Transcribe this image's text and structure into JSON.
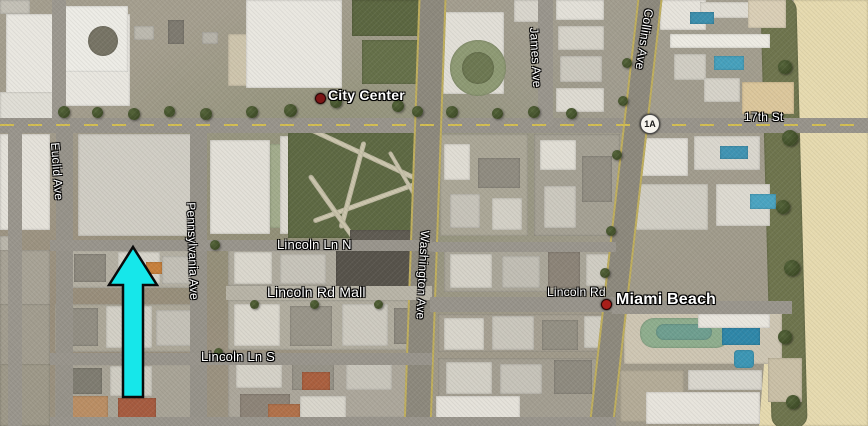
{
  "map": {
    "view": "satellite",
    "place_labels": [
      {
        "text": "City Center",
        "x": 328,
        "y": 87,
        "fs": 14,
        "fw": 600,
        "rot": 0
      },
      {
        "text": "Miami Beach",
        "x": 616,
        "y": 291,
        "fs": 16,
        "fw": 600,
        "rot": 0
      }
    ],
    "street_labels": [
      {
        "text": "17th St",
        "x": 744,
        "y": 110,
        "fs": 12,
        "fw": 400,
        "rot": 0
      },
      {
        "text": "Collins Ave",
        "x": 656,
        "y": 10,
        "fs": 12,
        "fw": 400,
        "rot": 99
      },
      {
        "text": "James Ave",
        "x": 541,
        "y": 27,
        "fs": 12,
        "fw": 400,
        "rot": 87
      },
      {
        "text": "Washington Ave",
        "x": 432,
        "y": 231,
        "fs": 12,
        "fw": 400,
        "rot": 93
      },
      {
        "text": "Pennsylvania Ave",
        "x": 198,
        "y": 202,
        "fs": 12,
        "fw": 400,
        "rot": 88
      },
      {
        "text": "Euclid Ave",
        "x": 62,
        "y": 142,
        "fs": 12,
        "fw": 400,
        "rot": 86
      },
      {
        "text": "Lincoln Ln N",
        "x": 277,
        "y": 237,
        "fs": 13,
        "fw": 400,
        "rot": 0
      },
      {
        "text": "Lincoln Rd Mall",
        "x": 267,
        "y": 284,
        "fs": 14,
        "fw": 400,
        "rot": 0
      },
      {
        "text": "Lincoln Ln S",
        "x": 201,
        "y": 349,
        "fs": 13,
        "fw": 400,
        "rot": 0
      },
      {
        "text": "Lincoln Rd",
        "x": 547,
        "y": 285,
        "fs": 12,
        "fw": 400,
        "rot": 0
      }
    ],
    "markers": [
      {
        "name": "city-center-marker",
        "x": 315,
        "y": 93,
        "d": 9,
        "c": "#7c1616"
      },
      {
        "name": "miami-beach-marker",
        "x": 601,
        "y": 299,
        "d": 9,
        "c": "#a81f1a"
      }
    ],
    "route_shield": {
      "text": "1A",
      "x": 640,
      "y": 114
    },
    "annotation_arrow": {
      "color": "#16e7ea",
      "outline": "#0a0a0a",
      "tip_x": 133,
      "tip_y": 247,
      "head_half": 24,
      "head_base_y": 285,
      "shaft_half": 10,
      "bottom_y": 397
    },
    "roads": [
      {
        "x": 0,
        "y": 118,
        "w": 868,
        "h": 15,
        "c": "#98948b"
      },
      {
        "x": 52,
        "y": 0,
        "w": 14,
        "h": 120,
        "c": "#9c988f"
      },
      {
        "x": 8,
        "y": 128,
        "w": 14,
        "h": 298,
        "c": "#9a968d"
      },
      {
        "x": 56,
        "y": 128,
        "w": 17,
        "h": 298,
        "c": "#97938a"
      },
      {
        "x": 190,
        "y": 128,
        "w": 17,
        "h": 298,
        "c": "#97938a"
      },
      {
        "x": 538,
        "y": 0,
        "w": 15,
        "h": 126,
        "c": "#9a968d"
      },
      {
        "x": 411,
        "y": -6,
        "w": 24,
        "h": 440,
        "c": "#8d897d",
        "rot": 2,
        "cls": "edges"
      },
      {
        "x": 613,
        "y": -8,
        "w": 21,
        "h": 444,
        "c": "#8d897d",
        "rot": 6.5,
        "cls": "edges"
      },
      {
        "x": 50,
        "y": 240,
        "w": 382,
        "h": 11,
        "c": "#99958c"
      },
      {
        "x": 432,
        "y": 242,
        "w": 184,
        "h": 10,
        "c": "#9a968d"
      },
      {
        "x": 226,
        "y": 286,
        "w": 206,
        "h": 14,
        "c": "#b8b4a7"
      },
      {
        "x": 430,
        "y": 297,
        "w": 186,
        "h": 15,
        "c": "#98948b"
      },
      {
        "x": 612,
        "y": 301,
        "w": 180,
        "h": 13,
        "c": "#9a968d"
      },
      {
        "x": 50,
        "y": 353,
        "w": 382,
        "h": 12,
        "c": "#99958c"
      },
      {
        "x": 50,
        "y": 417,
        "w": 566,
        "h": 9,
        "c": "#99958c"
      }
    ],
    "seventeenth_dash": {
      "x": 0,
      "y": 124,
      "w": 868,
      "h": 2
    },
    "patches": [
      {
        "x": 6,
        "y": 14,
        "w": 124,
        "h": 92,
        "c": "#e9e7e0"
      },
      {
        "x": 64,
        "y": 6,
        "w": 64,
        "h": 66,
        "c": "#edece6"
      },
      {
        "x": 88,
        "y": 26,
        "w": 30,
        "h": 30,
        "c": "#777465",
        "r": 15
      },
      {
        "x": 0,
        "y": 0,
        "w": 30,
        "h": 14,
        "c": "#c4c1b7"
      },
      {
        "x": 0,
        "y": 92,
        "w": 54,
        "h": 30,
        "c": "#e0ded6"
      },
      {
        "x": 134,
        "y": 26,
        "w": 20,
        "h": 14,
        "c": "#bcb9af"
      },
      {
        "x": 168,
        "y": 20,
        "w": 16,
        "h": 24,
        "c": "#7e7a70"
      },
      {
        "x": 202,
        "y": 32,
        "w": 16,
        "h": 12,
        "c": "#b7b4aa"
      },
      {
        "x": 228,
        "y": 34,
        "w": 26,
        "h": 52,
        "c": "#cec5ad"
      },
      {
        "x": 246,
        "y": 0,
        "w": 96,
        "h": 88,
        "c": "#e9e7e0"
      },
      {
        "x": 352,
        "y": 0,
        "w": 70,
        "h": 36,
        "c": "#5c6741"
      },
      {
        "x": 362,
        "y": 40,
        "w": 56,
        "h": 44,
        "c": "#66714a"
      },
      {
        "x": 442,
        "y": 12,
        "w": 62,
        "h": 82,
        "c": "#e2dfd7"
      },
      {
        "x": 450,
        "y": 40,
        "w": 56,
        "h": 56,
        "c": "#8e9a74",
        "r": 28
      },
      {
        "x": 462,
        "y": 52,
        "w": 32,
        "h": 32,
        "c": "#6d7852",
        "r": 16
      },
      {
        "x": 514,
        "y": 0,
        "w": 28,
        "h": 22,
        "c": "#d9d6cd"
      },
      {
        "x": 556,
        "y": 0,
        "w": 48,
        "h": 20,
        "c": "#e3e0d8"
      },
      {
        "x": 558,
        "y": 26,
        "w": 46,
        "h": 24,
        "c": "#d6d3c9"
      },
      {
        "x": 560,
        "y": 56,
        "w": 42,
        "h": 26,
        "c": "#ccc9bf"
      },
      {
        "x": 556,
        "y": 88,
        "w": 48,
        "h": 24,
        "c": "#dedbd2"
      },
      {
        "x": 660,
        "y": 0,
        "w": 46,
        "h": 30,
        "c": "#e7e4dc"
      },
      {
        "x": 700,
        "y": 2,
        "w": 58,
        "h": 16,
        "c": "#e0ddd4"
      },
      {
        "x": 690,
        "y": 12,
        "w": 24,
        "h": 12,
        "c": "#3d90ae"
      },
      {
        "x": 670,
        "y": 34,
        "w": 100,
        "h": 14,
        "c": "#edebe3"
      },
      {
        "x": 674,
        "y": 54,
        "w": 32,
        "h": 26,
        "c": "#d1cec4"
      },
      {
        "x": 714,
        "y": 56,
        "w": 30,
        "h": 14,
        "c": "#47a1bd"
      },
      {
        "x": 748,
        "y": 0,
        "w": 38,
        "h": 28,
        "c": "#dacfb6"
      },
      {
        "x": 704,
        "y": 78,
        "w": 36,
        "h": 24,
        "c": "#d6d3c9"
      },
      {
        "x": 742,
        "y": 82,
        "w": 52,
        "h": 32,
        "c": "#dcc79c"
      },
      {
        "x": 0,
        "y": 134,
        "w": 50,
        "h": 96,
        "c": "#e5e2da"
      },
      {
        "x": 0,
        "y": 236,
        "w": 22,
        "h": 62,
        "c": "#bbb7ac"
      },
      {
        "x": 78,
        "y": 134,
        "w": 118,
        "h": 102,
        "c": "#d0cdc4",
        "cls": "ridged"
      },
      {
        "x": 210,
        "y": 140,
        "w": 60,
        "h": 94,
        "c": "#e3e0d8"
      },
      {
        "x": 270,
        "y": 144,
        "w": 14,
        "h": 84,
        "c": "#a2ac8c"
      },
      {
        "x": 280,
        "y": 136,
        "w": 18,
        "h": 98,
        "c": "#dedbd2"
      },
      {
        "x": 288,
        "y": 132,
        "w": 146,
        "h": 106,
        "c": "#5e6943",
        "cls": "park"
      },
      {
        "x": 300,
        "y": 150,
        "w": 120,
        "h": 5,
        "c": "#cfc9b0",
        "rot": 25,
        "r": 3
      },
      {
        "x": 310,
        "y": 200,
        "w": 110,
        "h": 5,
        "c": "#cfc9b0",
        "rot": -20,
        "r": 3
      },
      {
        "x": 350,
        "y": 140,
        "w": 5,
        "h": 90,
        "c": "#ccc6ad",
        "rot": 15,
        "r": 3
      },
      {
        "x": 330,
        "y": 168,
        "w": 5,
        "h": 80,
        "c": "#ccc6ad",
        "rot": -35,
        "r": 3
      },
      {
        "x": 372,
        "y": 180,
        "w": 70,
        "h": 4,
        "c": "#cfc9b0",
        "rot": 60,
        "r": 3
      },
      {
        "x": 440,
        "y": 134,
        "w": 88,
        "h": 102,
        "c": "#aba797"
      },
      {
        "x": 444,
        "y": 144,
        "w": 26,
        "h": 36,
        "c": "#e0ddd4"
      },
      {
        "x": 478,
        "y": 158,
        "w": 42,
        "h": 30,
        "c": "#908c81"
      },
      {
        "x": 450,
        "y": 194,
        "w": 30,
        "h": 34,
        "c": "#c6c3b9"
      },
      {
        "x": 492,
        "y": 198,
        "w": 30,
        "h": 32,
        "c": "#d3d0c6"
      },
      {
        "x": 534,
        "y": 134,
        "w": 86,
        "h": 102,
        "c": "#a5a194"
      },
      {
        "x": 540,
        "y": 140,
        "w": 36,
        "h": 30,
        "c": "#e1ded5"
      },
      {
        "x": 582,
        "y": 156,
        "w": 30,
        "h": 46,
        "c": "#928e83"
      },
      {
        "x": 544,
        "y": 186,
        "w": 32,
        "h": 42,
        "c": "#ccc9bf"
      },
      {
        "x": 628,
        "y": 138,
        "w": 60,
        "h": 38,
        "c": "#e4e1d9"
      },
      {
        "x": 694,
        "y": 136,
        "w": 66,
        "h": 34,
        "c": "#dad7ce"
      },
      {
        "x": 720,
        "y": 146,
        "w": 28,
        "h": 13,
        "c": "#4094b3"
      },
      {
        "x": 634,
        "y": 184,
        "w": 74,
        "h": 46,
        "c": "#d1cec4"
      },
      {
        "x": 716,
        "y": 184,
        "w": 54,
        "h": 42,
        "c": "#dddad1"
      },
      {
        "x": 750,
        "y": 194,
        "w": 26,
        "h": 15,
        "c": "#4ba4c1"
      },
      {
        "x": 0,
        "y": 250,
        "w": 50,
        "h": 56,
        "c": "#a8a396"
      },
      {
        "x": 68,
        "y": 250,
        "w": 126,
        "h": 38,
        "c": "#b4b0a3"
      },
      {
        "x": 74,
        "y": 254,
        "w": 32,
        "h": 28,
        "c": "#8e8a7f"
      },
      {
        "x": 118,
        "y": 252,
        "w": 42,
        "h": 32,
        "c": "#d8d5cb"
      },
      {
        "x": 162,
        "y": 256,
        "w": 30,
        "h": 28,
        "c": "#c3c0b6"
      },
      {
        "x": 146,
        "y": 262,
        "w": 16,
        "h": 12,
        "c": "#c8813c"
      },
      {
        "x": 228,
        "y": 250,
        "w": 202,
        "h": 36,
        "c": "#afab9e"
      },
      {
        "x": 234,
        "y": 252,
        "w": 38,
        "h": 32,
        "c": "#dad7cd"
      },
      {
        "x": 280,
        "y": 254,
        "w": 46,
        "h": 30,
        "c": "#c7c4ba"
      },
      {
        "x": 336,
        "y": 250,
        "w": 94,
        "h": 38,
        "c": "#57534b"
      },
      {
        "x": 350,
        "y": 230,
        "w": 80,
        "h": 12,
        "c": "#5f5b52"
      },
      {
        "x": 444,
        "y": 250,
        "w": 172,
        "h": 42,
        "c": "#aaa699"
      },
      {
        "x": 450,
        "y": 254,
        "w": 42,
        "h": 34,
        "c": "#d6d3c9"
      },
      {
        "x": 502,
        "y": 256,
        "w": 38,
        "h": 32,
        "c": "#c1beb4"
      },
      {
        "x": 548,
        "y": 252,
        "w": 32,
        "h": 36,
        "c": "#8c8478"
      },
      {
        "x": 586,
        "y": 254,
        "w": 28,
        "h": 32,
        "c": "#d0cdc3"
      },
      {
        "x": 0,
        "y": 304,
        "w": 50,
        "h": 114,
        "c": "#a29d8f"
      },
      {
        "x": 55,
        "y": 304,
        "w": 140,
        "h": 48,
        "c": "#ada899"
      },
      {
        "x": 60,
        "y": 308,
        "w": 38,
        "h": 38,
        "c": "#928e83"
      },
      {
        "x": 106,
        "y": 306,
        "w": 46,
        "h": 42,
        "c": "#d3d0c6"
      },
      {
        "x": 156,
        "y": 310,
        "w": 38,
        "h": 36,
        "c": "#c4c1b7"
      },
      {
        "x": 228,
        "y": 300,
        "w": 202,
        "h": 50,
        "c": "#b1ad9f"
      },
      {
        "x": 234,
        "y": 304,
        "w": 46,
        "h": 42,
        "c": "#dbd8ce"
      },
      {
        "x": 290,
        "y": 306,
        "w": 42,
        "h": 40,
        "c": "#999589"
      },
      {
        "x": 342,
        "y": 304,
        "w": 46,
        "h": 42,
        "c": "#cdcac0"
      },
      {
        "x": 394,
        "y": 308,
        "w": 34,
        "h": 36,
        "c": "#8f8b80"
      },
      {
        "x": 438,
        "y": 314,
        "w": 178,
        "h": 38,
        "c": "#a6a092"
      },
      {
        "x": 444,
        "y": 318,
        "w": 40,
        "h": 32,
        "c": "#d8d5cb"
      },
      {
        "x": 492,
        "y": 316,
        "w": 42,
        "h": 34,
        "c": "#cac7bd"
      },
      {
        "x": 542,
        "y": 320,
        "w": 36,
        "h": 30,
        "c": "#949084"
      },
      {
        "x": 584,
        "y": 316,
        "w": 28,
        "h": 32,
        "c": "#d1cec4"
      },
      {
        "x": 624,
        "y": 308,
        "w": 158,
        "h": 56,
        "c": "#cec6b3"
      },
      {
        "x": 640,
        "y": 318,
        "w": 90,
        "h": 30,
        "c": "#8fae8e",
        "r": 14
      },
      {
        "x": 656,
        "y": 324,
        "w": 56,
        "h": 16,
        "c": "#6f9f90",
        "r": 8
      },
      {
        "x": 722,
        "y": 328,
        "w": 38,
        "h": 17,
        "c": "#2f87a9"
      },
      {
        "x": 734,
        "y": 350,
        "w": 20,
        "h": 18,
        "c": "#3d97b5",
        "r": 4
      },
      {
        "x": 698,
        "y": 314,
        "w": 72,
        "h": 14,
        "c": "#e9e6de"
      },
      {
        "x": 0,
        "y": 364,
        "w": 50,
        "h": 62,
        "c": "#9e9989"
      },
      {
        "x": 55,
        "y": 364,
        "w": 140,
        "h": 60,
        "c": "#a9a497"
      },
      {
        "x": 60,
        "y": 368,
        "w": 42,
        "h": 26,
        "c": "#7f7c71"
      },
      {
        "x": 110,
        "y": 366,
        "w": 42,
        "h": 30,
        "c": "#d0cdc3"
      },
      {
        "x": 62,
        "y": 396,
        "w": 46,
        "h": 26,
        "c": "#ba8e64"
      },
      {
        "x": 118,
        "y": 398,
        "w": 38,
        "h": 24,
        "c": "#a65c40"
      },
      {
        "x": 228,
        "y": 356,
        "w": 202,
        "h": 62,
        "c": "#aca79b"
      },
      {
        "x": 236,
        "y": 360,
        "w": 46,
        "h": 28,
        "c": "#d5d2c8"
      },
      {
        "x": 292,
        "y": 358,
        "w": 42,
        "h": 32,
        "c": "#979388"
      },
      {
        "x": 346,
        "y": 360,
        "w": 46,
        "h": 30,
        "c": "#c8c5bb"
      },
      {
        "x": 240,
        "y": 394,
        "w": 50,
        "h": 26,
        "c": "#8d8478"
      },
      {
        "x": 302,
        "y": 372,
        "w": 28,
        "h": 18,
        "c": "#ab603f"
      },
      {
        "x": 300,
        "y": 396,
        "w": 46,
        "h": 24,
        "c": "#d9d6cc"
      },
      {
        "x": 268,
        "y": 404,
        "w": 32,
        "h": 18,
        "c": "#b1714a"
      },
      {
        "x": 438,
        "y": 358,
        "w": 178,
        "h": 62,
        "c": "#a39e91"
      },
      {
        "x": 446,
        "y": 362,
        "w": 46,
        "h": 32,
        "c": "#d3d0c6"
      },
      {
        "x": 500,
        "y": 364,
        "w": 42,
        "h": 30,
        "c": "#c6c3b9"
      },
      {
        "x": 554,
        "y": 360,
        "w": 38,
        "h": 34,
        "c": "#8f8b80"
      },
      {
        "x": 436,
        "y": 396,
        "w": 84,
        "h": 28,
        "c": "#e5e2da"
      },
      {
        "x": 620,
        "y": 370,
        "w": 64,
        "h": 52,
        "c": "#b4ac98"
      },
      {
        "x": 688,
        "y": 370,
        "w": 74,
        "h": 20,
        "c": "#dad7ce"
      },
      {
        "x": 646,
        "y": 392,
        "w": 114,
        "h": 32,
        "c": "#e7e4dc"
      },
      {
        "x": 768,
        "y": 358,
        "w": 34,
        "h": 44,
        "c": "#cac0a7"
      }
    ],
    "sand": {
      "x": 752,
      "y": 0,
      "w": 116,
      "h": 426,
      "c": "#e6daaf"
    },
    "dune": {
      "x": 766,
      "y": -2,
      "w": 36,
      "h": 430,
      "c": "#6f754e",
      "rot": -1.5
    },
    "trees": [
      {
        "x": 58,
        "y": 106,
        "d": 12
      },
      {
        "x": 92,
        "y": 107,
        "d": 11
      },
      {
        "x": 128,
        "y": 108,
        "d": 12
      },
      {
        "x": 164,
        "y": 106,
        "d": 11
      },
      {
        "x": 200,
        "y": 108,
        "d": 12
      },
      {
        "x": 246,
        "y": 106,
        "d": 12
      },
      {
        "x": 284,
        "y": 104,
        "d": 13
      },
      {
        "x": 330,
        "y": 96,
        "d": 12
      },
      {
        "x": 392,
        "y": 100,
        "d": 12
      },
      {
        "x": 412,
        "y": 106,
        "d": 11
      },
      {
        "x": 446,
        "y": 106,
        "d": 12
      },
      {
        "x": 492,
        "y": 108,
        "d": 11
      },
      {
        "x": 528,
        "y": 106,
        "d": 12
      },
      {
        "x": 566,
        "y": 108,
        "d": 11
      },
      {
        "x": 622,
        "y": 58,
        "d": 10
      },
      {
        "x": 618,
        "y": 96,
        "d": 10
      },
      {
        "x": 612,
        "y": 150,
        "d": 10
      },
      {
        "x": 606,
        "y": 226,
        "d": 10
      },
      {
        "x": 600,
        "y": 268,
        "d": 10
      },
      {
        "x": 210,
        "y": 240,
        "d": 10
      },
      {
        "x": 250,
        "y": 300,
        "d": 9
      },
      {
        "x": 310,
        "y": 300,
        "d": 9
      },
      {
        "x": 374,
        "y": 300,
        "d": 9
      },
      {
        "x": 214,
        "y": 348,
        "d": 9
      },
      {
        "x": 778,
        "y": 60,
        "d": 14
      },
      {
        "x": 782,
        "y": 130,
        "d": 16
      },
      {
        "x": 776,
        "y": 200,
        "d": 14
      },
      {
        "x": 784,
        "y": 260,
        "d": 16
      },
      {
        "x": 778,
        "y": 330,
        "d": 14
      },
      {
        "x": 786,
        "y": 395,
        "d": 14
      }
    ]
  }
}
